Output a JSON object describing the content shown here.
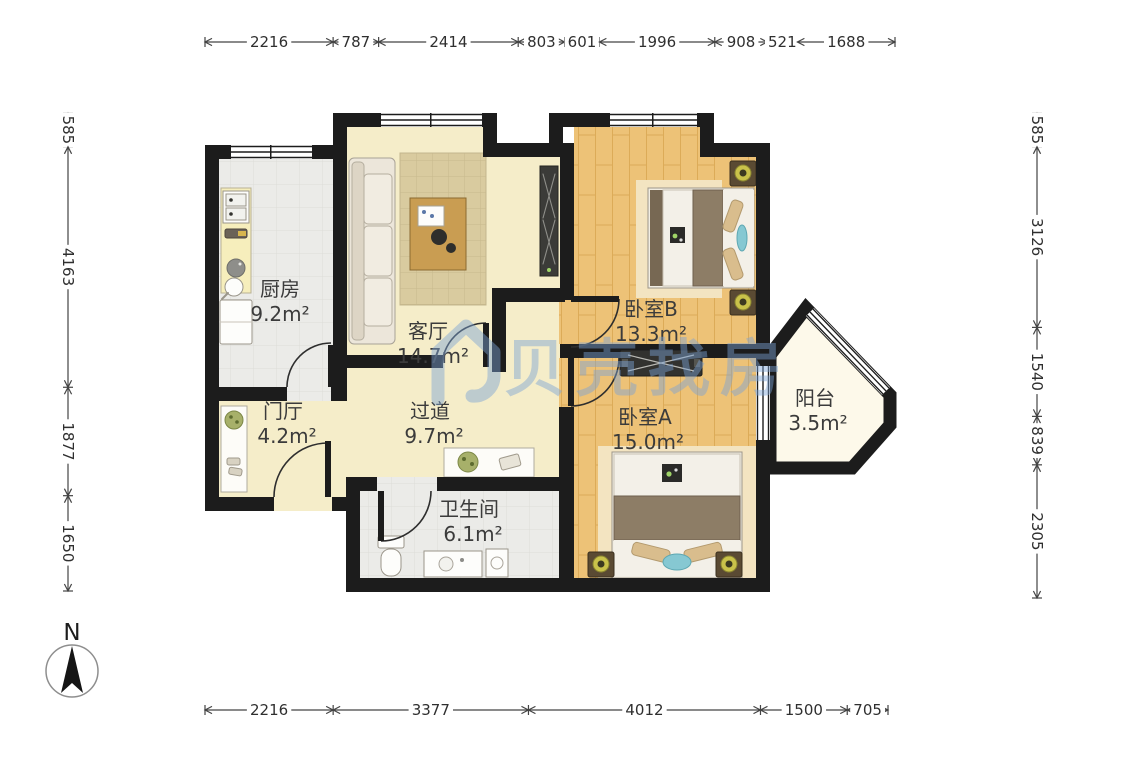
{
  "compass": {
    "label": "N"
  },
  "watermark": {
    "text": "贝壳找房",
    "color": "#7ba3d6"
  },
  "rooms": [
    {
      "id": "kitchen",
      "name": "厨房",
      "area": "9.2m²"
    },
    {
      "id": "living",
      "name": "客厅",
      "area": "14.7m²"
    },
    {
      "id": "bedroomB",
      "name": "卧室B",
      "area": "13.3m²"
    },
    {
      "id": "bedroomA",
      "name": "卧室A",
      "area": "15.0m²"
    },
    {
      "id": "balcony",
      "name": "阳台",
      "area": "3.5m²"
    },
    {
      "id": "foyer",
      "name": "门厅",
      "area": "4.2m²"
    },
    {
      "id": "hallway",
      "name": "过道",
      "area": "9.7m²"
    },
    {
      "id": "bathroom",
      "name": "卫生间",
      "area": "6.1m²"
    }
  ],
  "dimensions_mm": {
    "top": [
      2216,
      787,
      2414,
      803,
      601,
      1996,
      908,
      521,
      1688
    ],
    "bottom": [
      2216,
      3377,
      4012,
      1500,
      705
    ],
    "left": [
      585,
      4163,
      1877,
      1650
    ],
    "right": [
      585,
      3126,
      1540,
      839,
      2305
    ]
  },
  "colors": {
    "wall": "#1c1c1c",
    "wood_floor": "#edc277",
    "cream_floor": "#f5edc9",
    "tile_floor": "#ebebe8",
    "balcony_floor": "#fdf9ea",
    "dimension_line": "#444444",
    "watermark_blue": "#7ba3d6"
  }
}
